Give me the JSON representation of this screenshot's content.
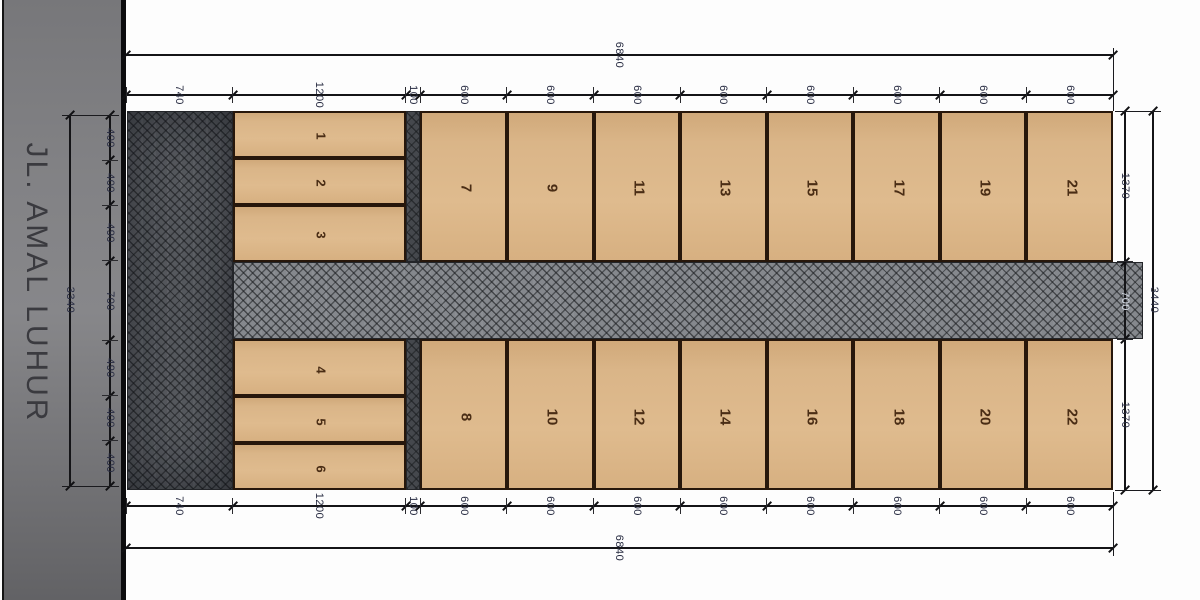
{
  "street": {
    "name": "JL. AMAL LUHUR"
  },
  "dimensions": {
    "top_chain": {
      "segments": [
        "740",
        "1200",
        "100",
        "600",
        "600",
        "600",
        "600",
        "600",
        "600",
        "600",
        "600"
      ],
      "total": "6840"
    },
    "bottom_chain": {
      "segments": [
        "740",
        "1200",
        "100",
        "600",
        "600",
        "600",
        "600",
        "600",
        "600",
        "600",
        "600"
      ],
      "total": "6840"
    },
    "right_chain": {
      "segments": [
        "1370",
        "700",
        "1370"
      ],
      "total": "3440"
    },
    "left_chain": {
      "segments": [
        "400",
        "400",
        "490",
        "700",
        "490",
        "400",
        "400"
      ],
      "total": "3340"
    }
  },
  "plots": {
    "small_top": [
      "1",
      "2",
      "3"
    ],
    "small_bottom": [
      "4",
      "5",
      "6"
    ],
    "top_row": [
      "7",
      "9",
      "11",
      "13",
      "15",
      "17",
      "19",
      "21"
    ],
    "bottom_row": [
      "8",
      "10",
      "12",
      "14",
      "16",
      "18",
      "20",
      "22"
    ]
  },
  "colors": {
    "plot_fill": "#dbb689",
    "hatch_road": "#7c7f84",
    "street_gray": "#7e7e81",
    "dim_text": "#262a40",
    "plot_number": "#4a2d15",
    "line": "#141417"
  }
}
